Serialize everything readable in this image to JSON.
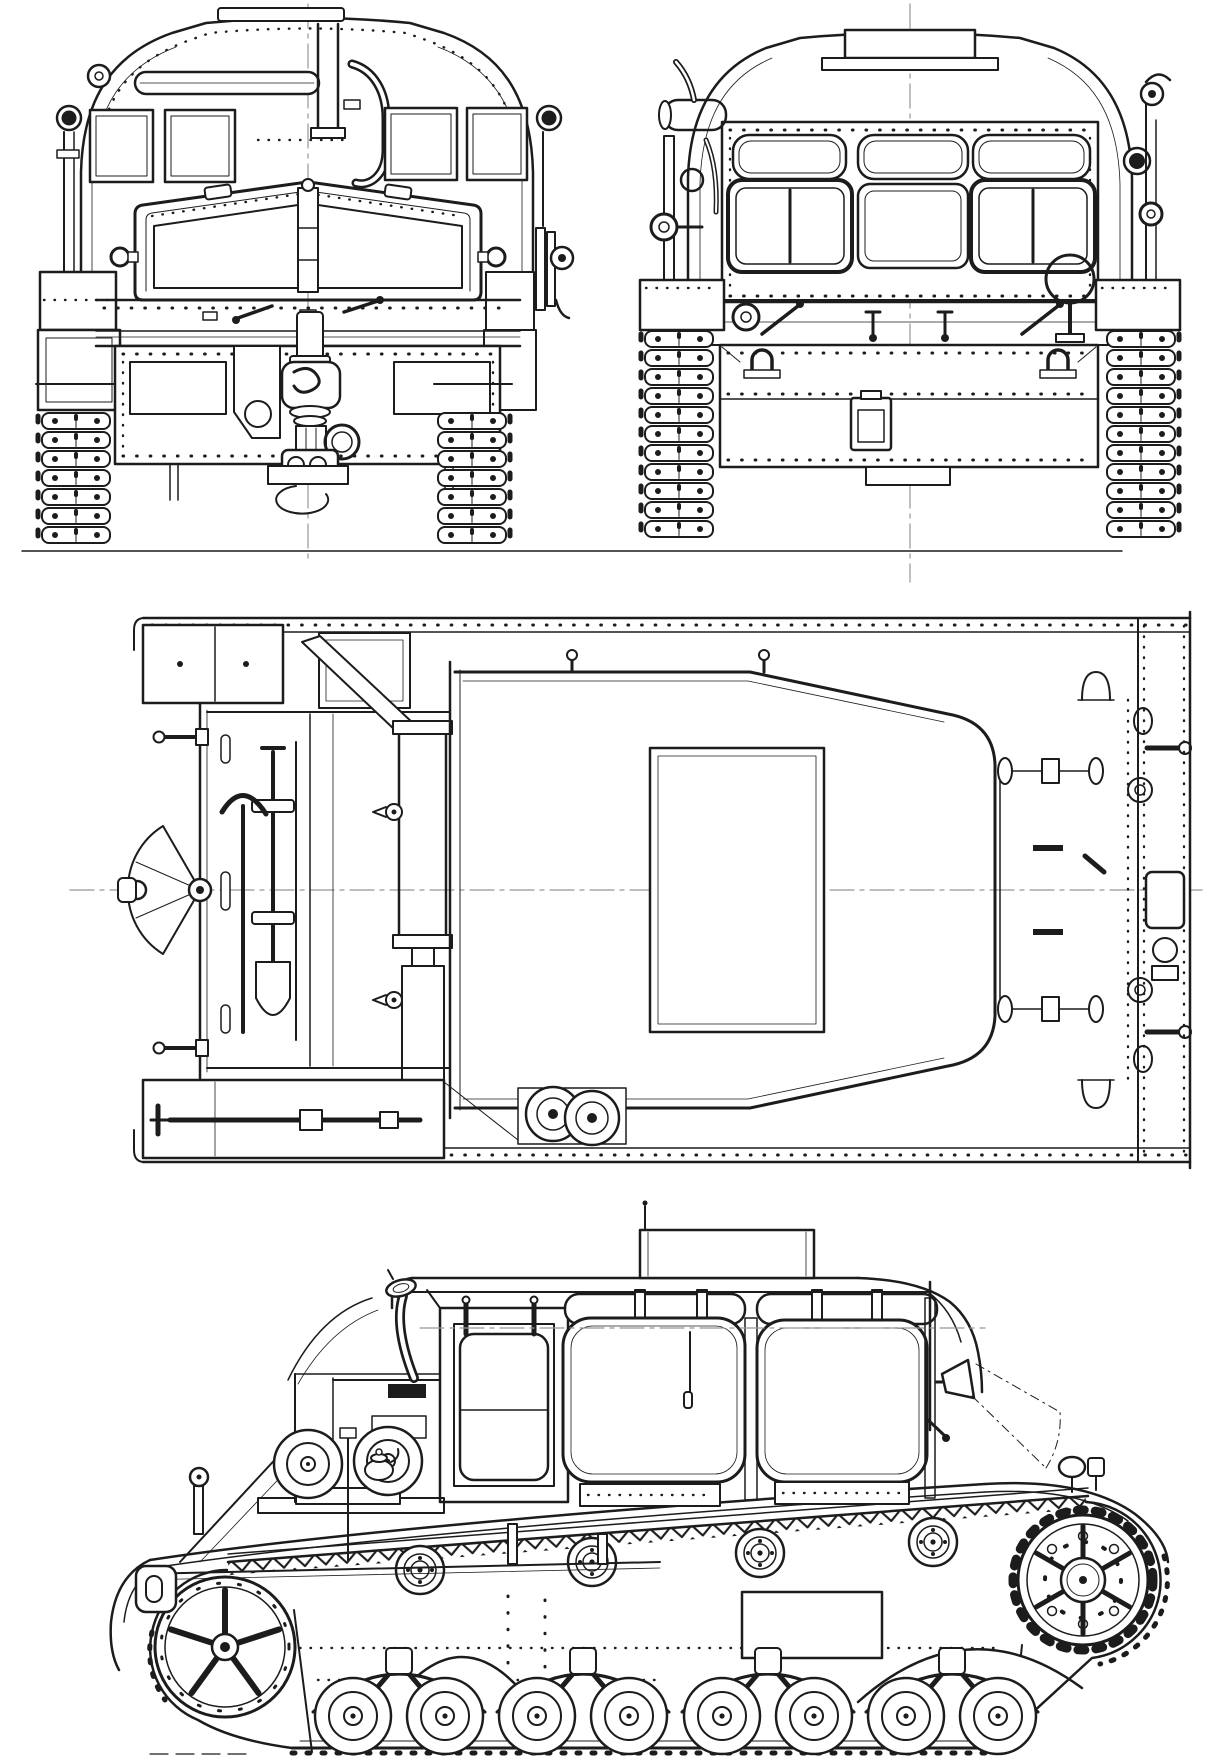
{
  "document": {
    "type": "technical-blueprint",
    "subject": "tracked artillery tractor, four-view orthographic line drawing",
    "background_color": "#ffffff",
    "ink_color": "#1c1c1c",
    "centerline_color": "#979797",
    "has_text_labels": false
  },
  "views": [
    {
      "id": "front-view",
      "label": "front elevation",
      "position": "top-left"
    },
    {
      "id": "rear-view",
      "label": "rear elevation",
      "position": "top-right"
    },
    {
      "id": "plan-view",
      "label": "top plan view",
      "position": "middle"
    },
    {
      "id": "side-view",
      "label": "left side elevation",
      "position": "bottom"
    }
  ]
}
